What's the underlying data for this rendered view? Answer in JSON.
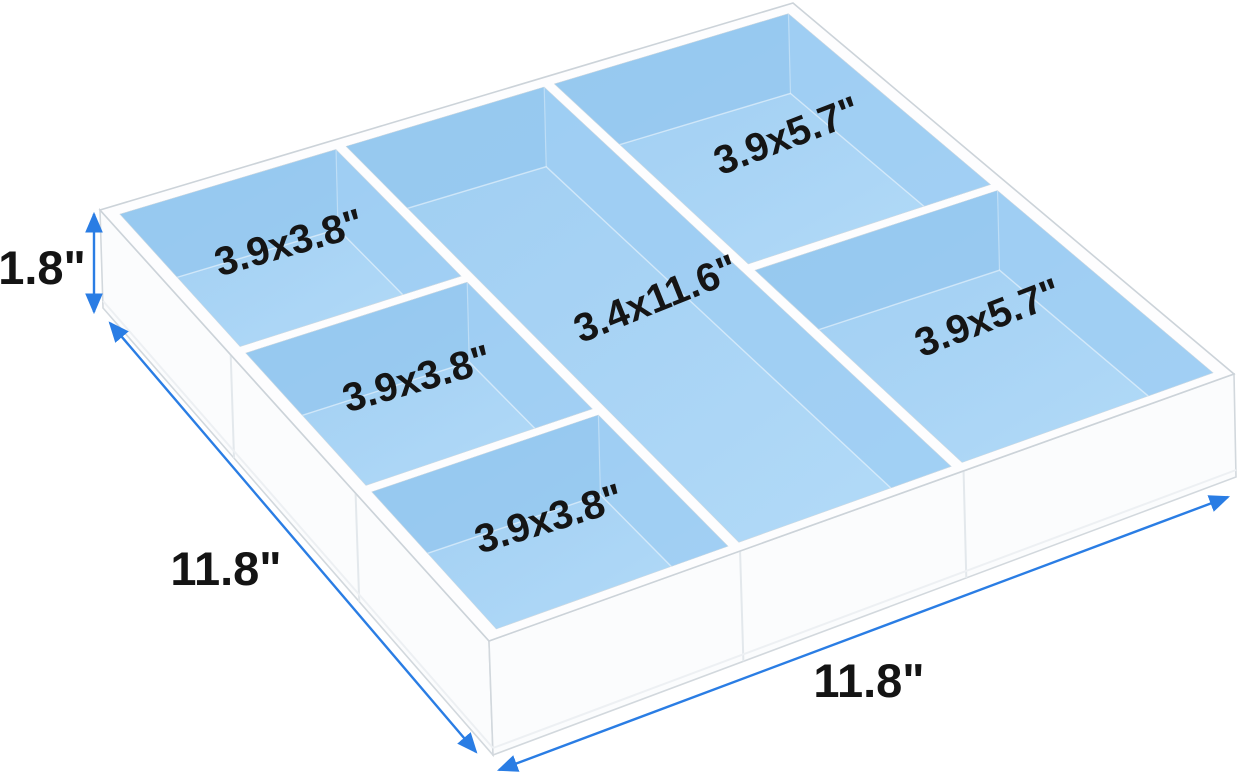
{
  "diagram": {
    "dimension_height_label": "1.8\"",
    "dimension_left_width_label": "11.8\"",
    "dimension_bottom_width_label": "11.8\"",
    "compartments": [
      {
        "id": "left-1",
        "label": "3.9x3.8\""
      },
      {
        "id": "left-2",
        "label": "3.9x3.8\""
      },
      {
        "id": "left-3",
        "label": "3.9x3.8\""
      },
      {
        "id": "middle",
        "label": "3.4x11.6\""
      },
      {
        "id": "right-1",
        "label": "3.9x5.7\""
      },
      {
        "id": "right-2",
        "label": "3.9x5.7\""
      }
    ],
    "colors": {
      "compartment_fill": "#a8d3f4",
      "compartment_wall_shade": "#95c8ef",
      "dimension_accent": "#2a7de4",
      "acrylic_edge": "#d2d8dd",
      "label_text": "#151515"
    }
  }
}
